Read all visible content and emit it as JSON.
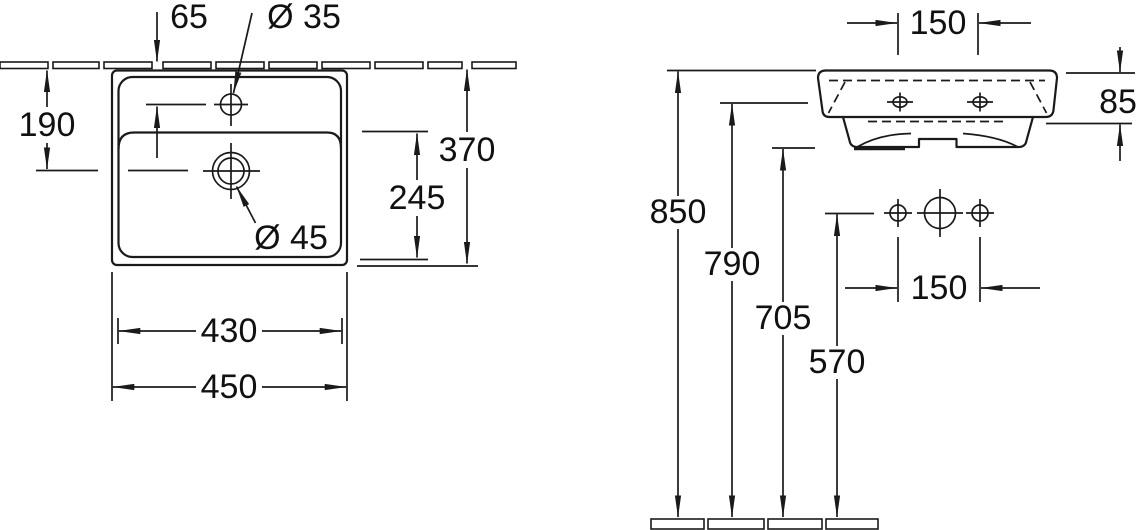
{
  "drawing": {
    "kind": "washbasin installation dimension drawing",
    "line_color": "#1a1a1a",
    "background": "#ffffff"
  },
  "plan_view": {
    "title": "plan view",
    "labels": {
      "tap_setback": "65",
      "tap_diameter": "Ø 35",
      "wall_to_drain": "190",
      "overall_depth": "370",
      "inner_depth": "245",
      "drain_diameter": "Ø 45",
      "inner_width": "430",
      "overall_width": "450"
    }
  },
  "front_view": {
    "title": "front view",
    "labels": {
      "tap_hole_spacing": "150",
      "basin_height": "85",
      "rim_height": "850",
      "tap_hole_height": "790",
      "underside_height": "705",
      "fixing_hole_height": "570",
      "fixing_hole_spacing": "150"
    }
  }
}
